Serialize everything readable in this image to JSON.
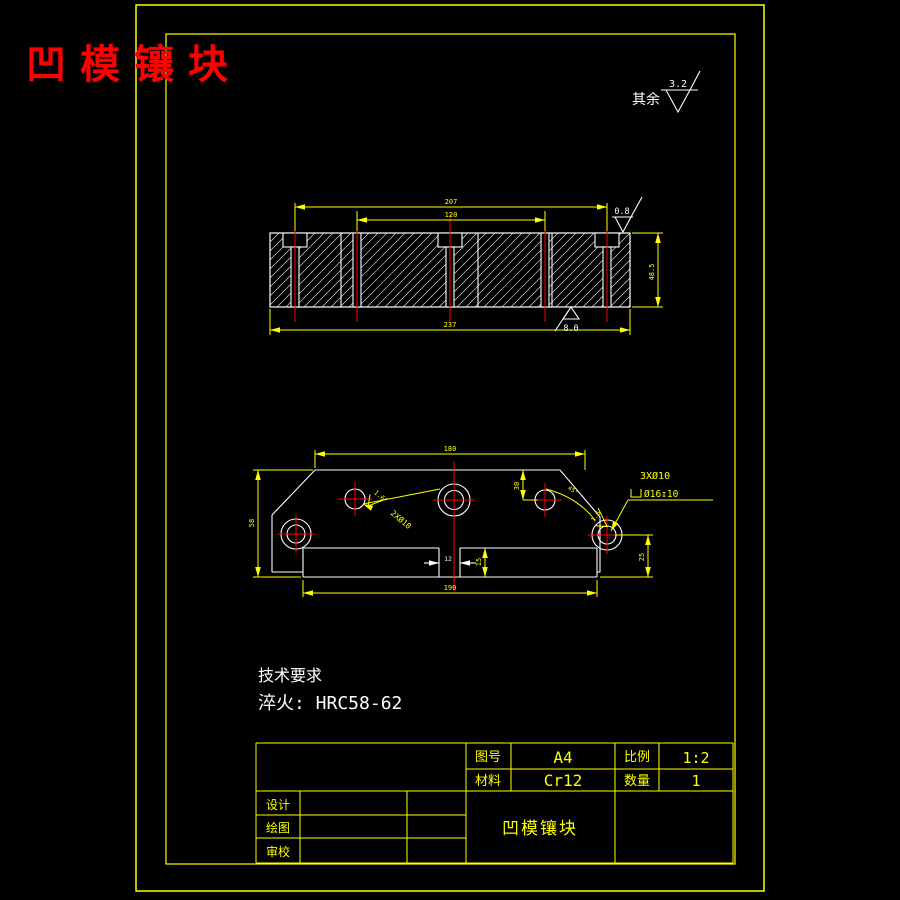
{
  "title": "凹模镶块",
  "general_note": {
    "prefix": "其余",
    "roughness": "3.2"
  },
  "section_view": {
    "dim_upper_span": "207",
    "dim_inner_span": "120",
    "dim_overall_width": "237",
    "dim_height": "48.5",
    "roughness_top_right": "0.8",
    "roughness_bottom": "8.0"
  },
  "plan_view": {
    "dim_top_width": "180",
    "dim_left_height": "58",
    "dim_hole_offset": "30",
    "dim_right_offset": "25",
    "dim_bottom_width": "190",
    "dim_notch_width": "12",
    "dim_notch_depth": "15",
    "dim_chamfer_angle": "45°",
    "callout_pin_holes": "2XØ10",
    "callout_cb_holes": "3XØ10",
    "callout_cb_detail": "Ø16↧10",
    "roughness_left": "1.6",
    "roughness_right": "1.6"
  },
  "tech_requirements": {
    "heading": "技术要求",
    "line1": "淬火: HRC58-62"
  },
  "title_block": {
    "drawing_no_label": "图号",
    "drawing_no": "A4",
    "scale_label": "比例",
    "scale": "1:2",
    "material_label": "材料",
    "material": "Cr12",
    "qty_label": "数量",
    "qty": "1",
    "design_label": "设计",
    "draw_label": "绘图",
    "check_label": "审校",
    "part_name": "凹模镶块"
  },
  "colors": {
    "line_accent": "#ffff00",
    "outline": "#ffffff",
    "centerline": "#ff0000",
    "title": "#fe0000",
    "background": "#000000"
  }
}
